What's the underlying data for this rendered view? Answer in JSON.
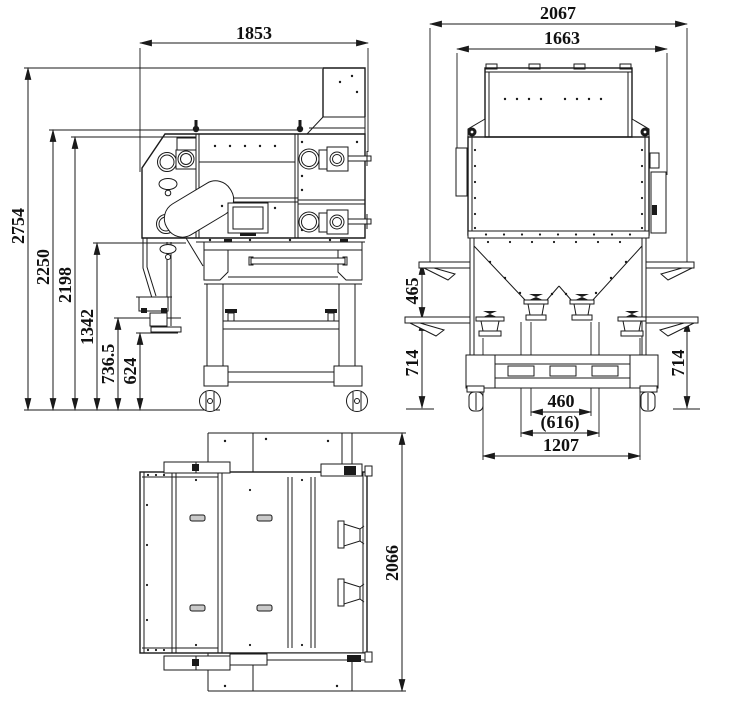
{
  "drawing_type": "three-view dimensioned machine drawing",
  "side_view": {
    "label": "side view",
    "dims": {
      "width_top": "1853",
      "height_overall": "2754",
      "height_upper": "2250",
      "height_body_top": "2198",
      "height_mid": "1342",
      "height_outlet": "736.5",
      "height_bracket": "624"
    }
  },
  "front_view": {
    "label": "front view",
    "dims": {
      "width_overall": "2067",
      "width_inner": "1663",
      "side_gap_upper": "465",
      "side_height_left": "714",
      "side_height_right": "714",
      "outlet_span_inner": "460",
      "outlet_span_mid": "(616)",
      "outlet_span_outer": "1207"
    }
  },
  "top_view": {
    "label": "top view",
    "dims": {
      "depth_overall": "2066"
    }
  },
  "style": {
    "line_color": "#1a1a1a",
    "background": "#ffffff"
  }
}
